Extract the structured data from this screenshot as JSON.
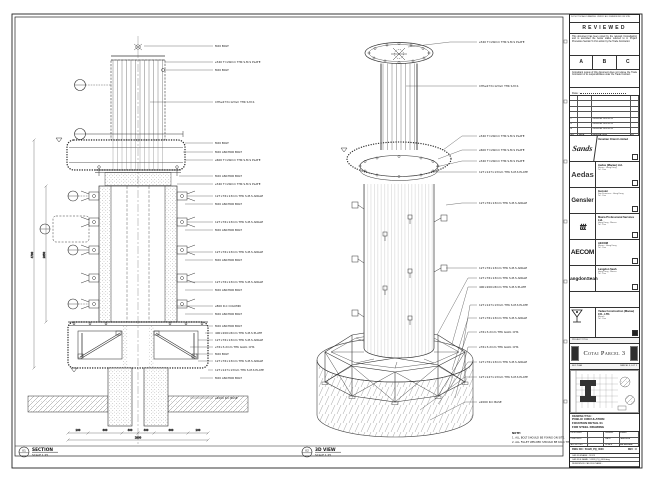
{
  "views": {
    "section": {
      "tag": "01",
      "title": "SECTION",
      "scale": "SCALE 1:25",
      "callouts": [
        "M20 BOLT",
        "⌀340 T=20mm THK S.M.S PLATE",
        "M20 BOLT",
        "CHS⌀273×12mm THK S.M.S",
        "M20 BOLT",
        "M20 ANCHOR BOLT",
        "⌀600 T=20mm THK S.M.S PLATE",
        "M20 ANCHOR BOLT",
        "⌀340 T=20mm THK S.M.S PLATE",
        "127×76×13mm THK S.M.S ANGLE",
        "M20 ANCHOR BOLT",
        "127×76×13mm THK S.M.S ANGLE",
        "M20 ANCHOR BOLT",
        "127×76×13mm THK S.M.S ANGLE",
        "M20 ANCHOR BOLT",
        "127×76×13mm THK S.M.S ANGLE",
        "M20 ANCHOR BOLT",
        "⌀800 R.C COLUMN",
        "M20 ANCHOR BOLT",
        "M20 ANCHOR BOLT",
        "400×200×8mm THK S.M.S PLATE",
        "127×76×13mm THK S.M.S ANGLE",
        "⌀76×3.2mm THK GALV. CHS",
        "M20 BOLT",
        "127×76×13mm THK S.M.S ANGLE",
        "127×127×13mm THK S.M.S PLATE",
        "M20 ANCHOR BOLT",
        "⌀2000 R.C BASE"
      ],
      "dims": {
        "segs": [
          "200",
          "800",
          "400",
          "400",
          "800",
          "200"
        ],
        "total": "2800",
        "height": "4700",
        "inner": "2850"
      }
    },
    "view3d": {
      "tag": "02",
      "title": "3D VIEW",
      "scale": "SCALE 1:25",
      "callouts": [
        "⌀340 T=20mm THK S.M.S PLATE",
        "CHS⌀273×12mm THK S.M.S",
        "⌀340 T=20mm THK S.M.S PLATE",
        "⌀600 T=20mm THK S.M.S PLATE",
        "⌀340 T=20mm THK S.M.S PLATE",
        "127×127×13mm THK S.M.S PLATE",
        "127×76×13mm THK S.M.S ANGLE",
        "127×76×13mm THK S.M.S ANGLE",
        "127×76×13mm THK S.M.S ANGLE",
        "400×200×8mm THK S.M.S PLATE",
        "127×127×13mm THK S.M.S PLATE",
        "127×76×13mm THK S.M.S ANGLE",
        "⌀76×3.2mm THK GALV. CHS",
        "⌀76×3.2mm THK GALV. CHS",
        "127×76×13mm THK S.M.S ANGLE",
        "127×127×13mm THK S.M.S PLATE",
        "⌀2000 R.C BASE"
      ],
      "note": {
        "title": "NOTE:",
        "l1": "1. ALL BOLT SHOULD BE FIXING ON SITE.",
        "l2": "2. ALL FILLET WELDED SHOULD BE 6mm THK."
      }
    }
  },
  "titleblock": {
    "top_note": "DO NOT SCALE DRAWING. VERIFY ALL DIMENSIONS ON SITE.",
    "reviewed": {
      "title": "REVIEWED",
      "para1": "This document has been noted by the relevant Consultant(s) and is accorded the below status referred to in Project Procedure Section 5.4 for action by the Trade Contractor.",
      "boxes": [
        "A",
        "B",
        "C"
      ],
      "para2": "Consultant review of this document does not relieve the Trade Contractor of its responsibilities under the Trade Contract.",
      "date_label": "Date :"
    },
    "revisions": {
      "header": [
        "NO.",
        "DATE",
        "DESCRIPTION",
        "BY"
      ],
      "rows": [
        [
          "C",
          "",
          "GENERAL REVISION",
          ""
        ],
        [
          "B",
          "",
          "GENERAL REVISION",
          ""
        ],
        [
          "A",
          "",
          "GENERAL REVISION",
          ""
        ]
      ]
    },
    "companies": [
      {
        "logo": "Sands",
        "name": "Venetian Orient Limited",
        "l1": "",
        "l2": ""
      },
      {
        "logo": "Aedas",
        "name": "Aedas (Macau) Ltd.",
        "l1": "Macau · Hong Kong",
        "l2": "Tel · Fax"
      },
      {
        "logo": "Gensler",
        "name": "Gensler",
        "l1": "San Francisco · Hong Kong",
        "l2": "Tel · Fax"
      },
      {
        "logo": "ttt",
        "name": "Maica Professional Services Ltd.",
        "l1": "Hong Kong · Macau",
        "l2": "Tel · Fax"
      },
      {
        "logo": "AECOM",
        "name": "AECOM",
        "l1": "Macau · Hong Kong",
        "l2": "Tel · Fax"
      },
      {
        "logo": "LangdonSeah",
        "name": "Langdon Seah",
        "l1": "Hong Kong · Macau",
        "l2": "Tel · Fax"
      }
    ],
    "contractor": {
      "name": "Yadea Construction (Macau) CO., LTD.",
      "l1": "Macau",
      "l2": "Tel · Fax"
    },
    "project": {
      "band": "PROJECT TITLE",
      "name": "Cotai Parcel 3"
    },
    "keyplan": {
      "label": "KEY PLAN",
      "right": "PARCEL 3, LOT 2"
    },
    "drawing": {
      "label": "DRAWING TITLE :",
      "lines": [
        "PUBLIC CIRCULATION",
        "FOUNTAIN DETAIL 01",
        "FOR STEEL DRAWING"
      ],
      "fields": [
        [
          "DESIGNED",
          "",
          "DRAWN",
          "LUHO"
        ],
        [
          "CHECKED",
          "-",
          "DATE",
          "JUN 2015"
        ],
        [
          "APPROVED",
          "-",
          "SCALE",
          "AS SHOWN"
        ]
      ],
      "dwg_label": "DWG NO : 51928_PQ_0000",
      "rev_label": "REV : C",
      "cad1": "CAD FILENAME : 51928",
      "cad2": "CAD FILE NAME : 51928_PQ_0000.dwg",
      "cad3": "REFERENCE CAD FILE NAME :"
    }
  }
}
